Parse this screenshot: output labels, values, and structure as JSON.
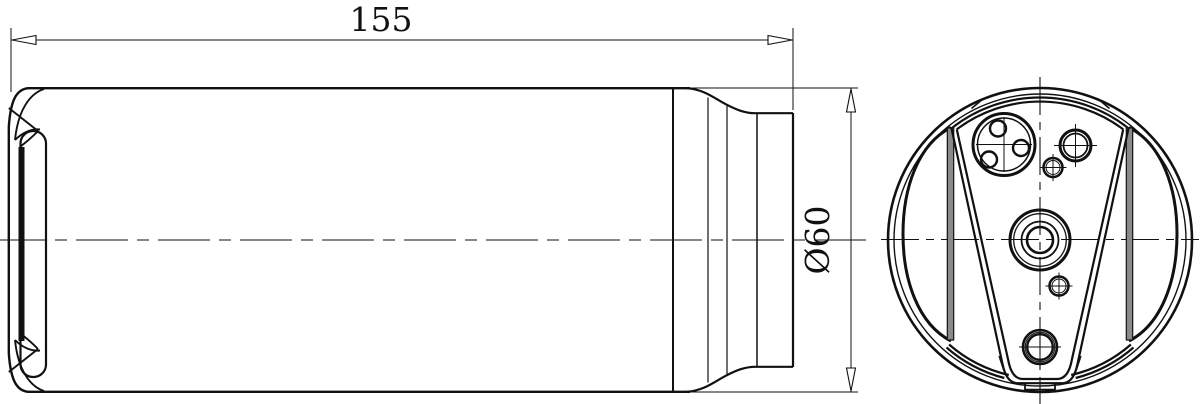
{
  "drawing": {
    "title": "cylindrical-receiver-drier-two-view-drawing",
    "background_color": "#ffffff",
    "line_color": "#111111",
    "chord_fill_color": "#8a8a8a",
    "dimensions": {
      "length": {
        "label": "155"
      },
      "diameter": {
        "label": "Ø60"
      }
    },
    "views": {
      "side_view": {
        "name": "side view (cylinder with stepped neck)"
      },
      "end_view": {
        "name": "end view (flange with ports)"
      }
    }
  }
}
